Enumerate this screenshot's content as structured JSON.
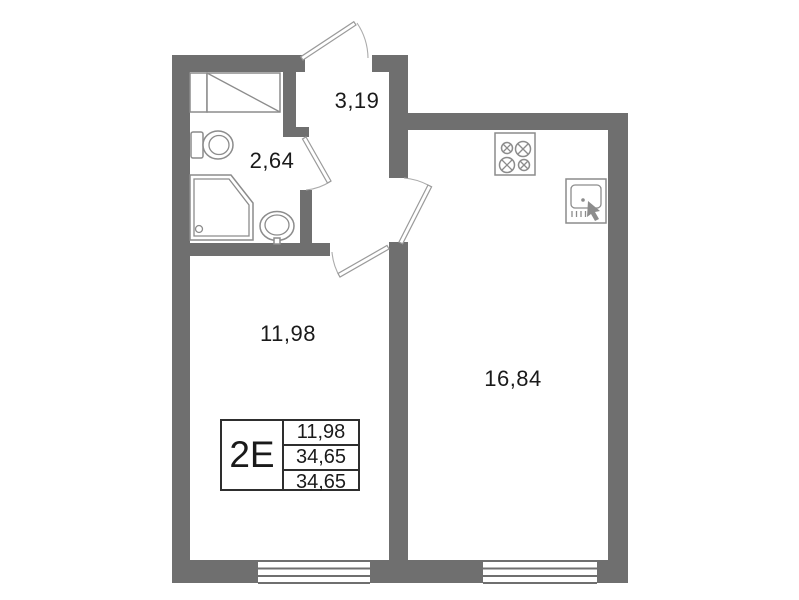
{
  "plan": {
    "title": "apartment-floor-plan",
    "info_box": {
      "unit": "2E",
      "rows": [
        "11,98",
        "34,65",
        "34,65"
      ]
    },
    "rooms": [
      {
        "name": "hallway",
        "area": "3,19"
      },
      {
        "name": "bathroom",
        "area": "2,64"
      },
      {
        "name": "living-room",
        "area": "11,98"
      },
      {
        "name": "kitchen",
        "area": "16,84"
      }
    ],
    "fixtures": [
      {
        "icon": "bathtub-icon"
      },
      {
        "icon": "bathtub-shelf-icon"
      },
      {
        "icon": "toilet-icon"
      },
      {
        "icon": "shower-icon"
      },
      {
        "icon": "bathroom-sink-icon"
      },
      {
        "icon": "stove-icon"
      },
      {
        "icon": "kitchen-sink-icon"
      }
    ],
    "doors": [
      "entrance-door",
      "bathroom-door",
      "kitchen-door",
      "living-room-door"
    ],
    "windows": [
      "living-room-window",
      "kitchen-window"
    ],
    "colors": {
      "wall": "#6f6f6f",
      "line": "#8c8c8c",
      "text": "#1a1a1a"
    }
  }
}
